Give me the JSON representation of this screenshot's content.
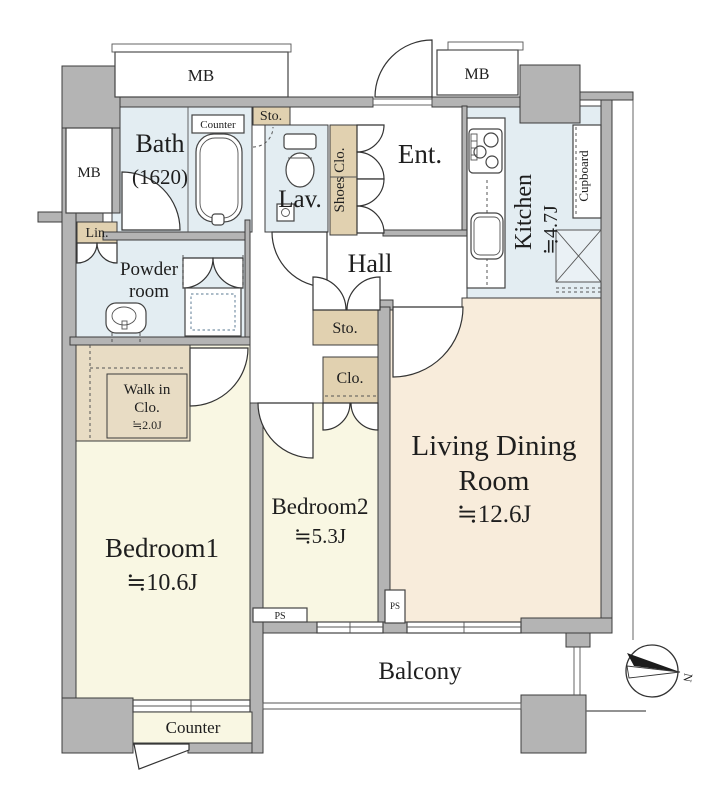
{
  "plan": {
    "rooms": {
      "bath": {
        "name": "Bath",
        "size": "(1620)"
      },
      "powder_room": {
        "line1": "Powder",
        "line2": "room"
      },
      "lavatory": {
        "name": "Lav."
      },
      "entrance": {
        "name": "Ent."
      },
      "hall": {
        "name": "Hall"
      },
      "kitchen": {
        "name": "Kitchen",
        "area": "≒4.7J"
      },
      "living_dining": {
        "line1": "Living Dining",
        "line2": "Room",
        "area": "≒12.6J"
      },
      "bedroom1": {
        "name": "Bedroom1",
        "area": "≒10.6J"
      },
      "bedroom2": {
        "name": "Bedroom2",
        "area": "≒5.3J"
      },
      "walk_in_closet": {
        "line1": "Walk in",
        "line2": "Clo.",
        "area": "≒2.0J"
      },
      "balcony": {
        "name": "Balcony"
      }
    },
    "labels": {
      "meter_box": "MB",
      "storage": "Sto.",
      "closet": "Clo.",
      "linen": "Lin.",
      "shoes_closet": "Shoes Clo.",
      "cupboard": "Cupboard",
      "bath_counter": "Counter",
      "bedroom_counter": "Counter",
      "pipe_space": "PS",
      "north": "N"
    },
    "colors": {
      "wall": "#b4b4b4",
      "wet_rooms": "#e3edf2",
      "bedrooms": "#f9f7e3",
      "living": "#f8ecdb",
      "closets": "#e1d1b0"
    }
  }
}
